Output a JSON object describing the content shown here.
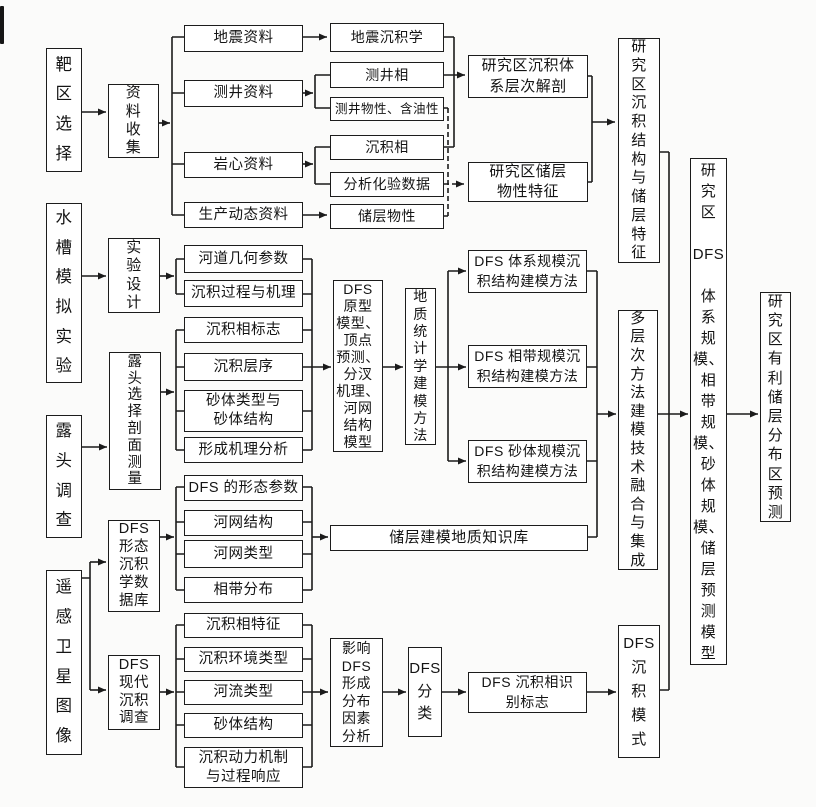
{
  "style": {
    "line_color": "#1b1b1b",
    "box_bg": "#ffffff",
    "page_bg": "#fbfbfa",
    "text_color": "#141414"
  },
  "nodes": {
    "target_area": "靶\n区\n选\n择",
    "flume_experiment": "水\n槽\n模\n拟\n实\n验",
    "outcrop_survey": "露\n头\n调\n查",
    "remote_sensing": "遥\n感\n卫\n星\n图\n像",
    "data_collection": "资\n料\n收\n集",
    "experiment_design": "实\n验\n设\n计",
    "outcrop_selection": "露\n头\n选\n择\n剖\n面\n测\n量",
    "dfs_morph_db": "DFS\n形态\n沉积\n学数\n据库",
    "dfs_modern_survey": "DFS\n现代\n沉积\n调查",
    "seismic_data": "地震资料",
    "well_log_data": "测井资料",
    "core_data": "岩心资料",
    "production_data": "生产动态资料",
    "seismic_sedimentology": "地震沉积学",
    "well_log_facies": "测井相",
    "well_log_properties": "测井物性、含油性",
    "sedimentary_facies": "沉积相",
    "lab_analysis_data": "分析化验数据",
    "reservoir_properties": "储层物性",
    "hierarchy_analysis": "研究区沉积体\n系层次解剖",
    "reservoir_property_char": "研究区储层\n物性特征",
    "structure_reservoir_char": "研\n究\n区\n沉\n积\n结\n构\n与\n储\n层\n特\n征",
    "channel_geometry": "河道几何参数",
    "sediment_process": "沉积过程与机理",
    "facies_markers": "沉积相标志",
    "sediment_sequence": "沉积层序",
    "sandbody_type": "砂体类型与\n砂体结构",
    "formation_mechanism": "形成机理分析",
    "dfs_prototype": "DFS\n原型\n模型、\n顶点\n预测、\n分汊\n机理、\n河网\n结构\n模型",
    "geostat_modeling": "地\n质\n统\n计\n学\n建\n模\n方\n法",
    "dfs_system_modeling": "DFS 体系规模沉\n积结构建模方法",
    "dfs_belt_modeling": "DFS 相带规模沉\n积结构建模方法",
    "dfs_sand_modeling": "DFS 砂体规模沉\n积结构建模方法",
    "multilevel_integration": "多\n层\n次\n方\n法\n建\n模\n技\n术\n融\n合\n与\n集\n成",
    "dfs_scale_models": "研\n究\n区\n\nDFS\n\n体\n系\n规\n模、\n相\n带\n规\n模、\n砂\n体\n规\n模、\n储\n层\n预\n测\n模\n型",
    "favorable_prediction": "研\n究\n区\n有\n利\n储\n层\n分\n布\n区\n预\n测",
    "dfs_morph_params": "DFS 的形态参数",
    "river_network_structure": "河网结构",
    "river_network_type": "河网类型",
    "facies_belt_distribution": "相带分布",
    "knowledge_base": "储层建模地质知识库",
    "facies_characteristics": "沉积相特征",
    "environment_type": "沉积环境类型",
    "river_type": "河流类型",
    "sandbody_structure": "砂体结构",
    "sediment_dynamics": "沉积动力机制\n与过程响应",
    "influence_analysis": "影响\nDFS\n形成\n分布\n因素\n分析",
    "dfs_classification": "DFS\n分\n类",
    "dfs_facies_id_markers": "DFS 沉积相识\n别标志",
    "dfs_sediment_pattern": "DFS\n沉\n积\n模\n式"
  }
}
